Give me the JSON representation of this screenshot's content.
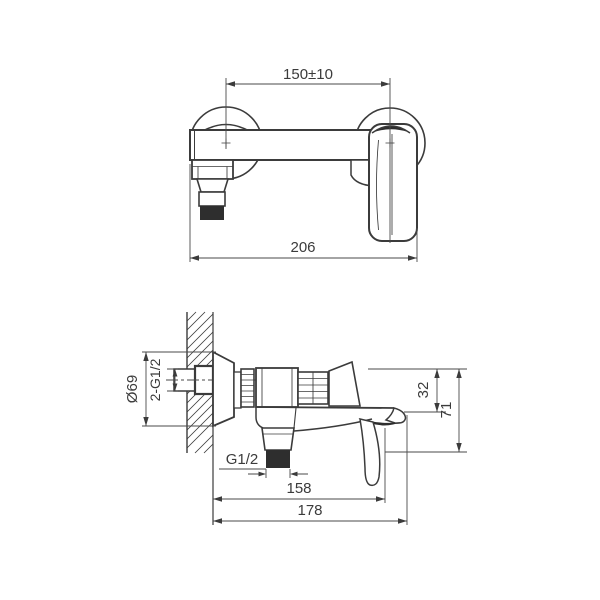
{
  "style": {
    "background": "#ffffff",
    "line_color": "#3b3b3b",
    "thread_fill": "#2e2e2e"
  },
  "drawing": {
    "front_view": {
      "dim_center_distance": "150±10",
      "dim_overall_width": "206"
    },
    "side_view": {
      "dim_escutcheon_diameter": "Ø69",
      "dim_inlet_connections": "2-G1/2",
      "dim_outlet_thread": "G1/2",
      "dim_top_to_spout": "32",
      "dim_top_to_bottom": "71",
      "dim_wall_to_handle": "158",
      "dim_overall_depth": "178"
    }
  }
}
